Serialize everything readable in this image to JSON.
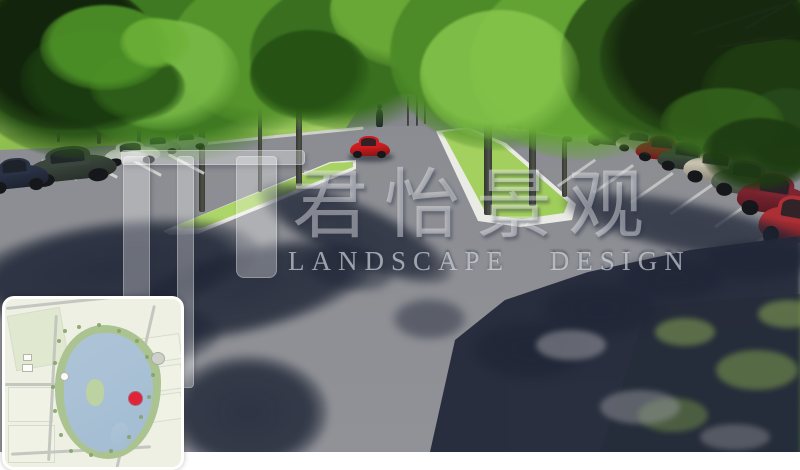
{
  "image_type": "3d-landscape-design-rendering",
  "watermark": {
    "logo_mark": "junyi-monogram-bars",
    "title_cn": "君怡景观",
    "subtitle_en": "LANDSCAPE  DESIGN",
    "text_color": "rgba(240,242,245,0.5)"
  },
  "palette": {
    "sky": "#9cc3e8",
    "canopy_dark": "#1d3a12",
    "canopy_light": "#7cbd49",
    "grass_sunlit": "#93c253",
    "median_grass": "#a9d45e",
    "road": "#8b8d92",
    "curb": "#ebebe6",
    "tree_shadow": "#242a3a",
    "bottom_band": "#ffffff"
  },
  "scene": {
    "description": "tree-lined parking avenue with two planted median islands",
    "driving_car": {
      "type": "sports-car",
      "color": "#cf1d1f"
    },
    "distant_parked_car_color": "#b52c2c",
    "left_parked_car_colors": [
      "#c6cacd",
      "#aab2ac",
      "#e9eae8",
      "#3a463d",
      "#2a3246"
    ],
    "right_parked_car_colors": [
      "#d9dad6",
      "#2f4134",
      "#cfcaba",
      "#a42127",
      "#3c4a40",
      "#c7c1ae",
      "#5d6e59",
      "#7c2430",
      "#ad2f36"
    ],
    "pedestrian_present": true
  },
  "inset_map": {
    "type": "site-plan-key-map",
    "lake_color": "#a9c0d6",
    "vegetation_color": "#abc390",
    "field_color": "#f0f2e6",
    "road_color": "#c3c7bf",
    "marker": "current-viewpoint",
    "marker_color": "#e02339"
  }
}
